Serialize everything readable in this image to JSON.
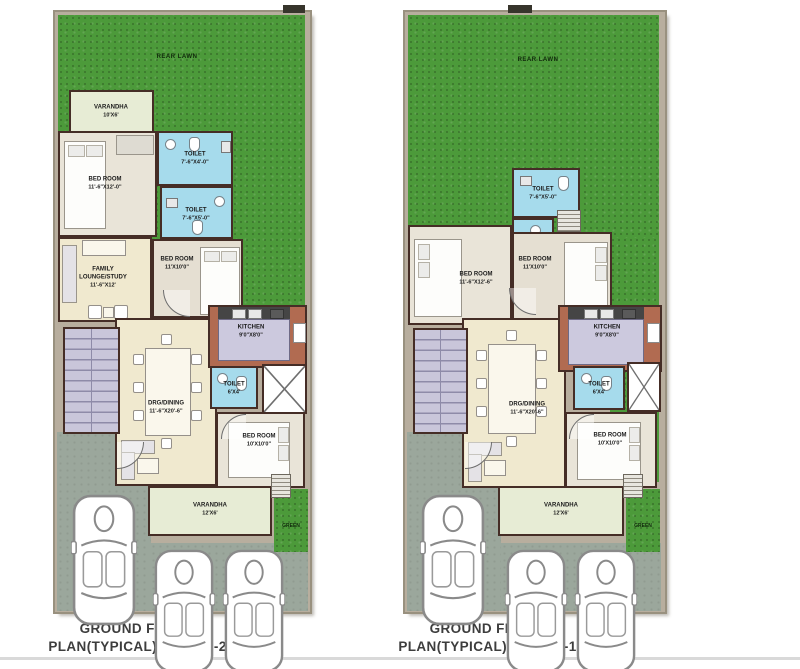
{
  "colors": {
    "lawn_green": "#4c9a3a",
    "wall_brown": "#452d26",
    "toilet_blue": "#a6dbec",
    "kitchen_brick": "#b16b51",
    "kitchen_floor": "#ccc9de",
    "room_cream": "#f0e9cf",
    "bedroom_floor": "#e9e4d8",
    "stairs_lavender": "#c9c6da",
    "driveway_gray": "#9ba79c",
    "varandha_pale": "#e7ecd5",
    "plot_band_tan": "#b8ae9e",
    "title_gray": "#3d3d3d"
  },
  "plans": {
    "left": {
      "title_line1": "GROUND FLOOR",
      "title_line2": "PLAN(TYPICAL)  PHASE-2",
      "lawn_label": "REAR LAWN",
      "green_label": "GREEN",
      "rooms": {
        "varandha_top": {
          "name": "VARANDHA",
          "dims": "10'X6'"
        },
        "bed_top": {
          "name": "BED ROOM",
          "dims": "11'-6\"X12'-0\""
        },
        "toilet_a": {
          "name": "TOILET",
          "dims": "7'-6\"X4'-0\""
        },
        "toilet_b": {
          "name": "TOILET",
          "dims": "7'-6\"X5'-0\""
        },
        "bed_mid": {
          "name": "BED ROOM",
          "dims": "11'X10'0\""
        },
        "family": {
          "name": "FAMILY LOUNGE/STUDY",
          "dims": "11'-6\"X12'"
        },
        "kitchen": {
          "name": "KITCHEN",
          "dims": "9'0\"X8'0\""
        },
        "toilet_c": {
          "name": "TOILET",
          "dims": "6'X4'"
        },
        "drg": {
          "name": "DRG/DINING",
          "dims": "11'-6\"X20'-6\""
        },
        "bed_bottom": {
          "name": "BED ROOM",
          "dims": "10'X10'0\""
        },
        "varandha_bottom": {
          "name": "VARANDHA",
          "dims": "12'X6'"
        }
      }
    },
    "right": {
      "title_line1": "GROUND FLOOR",
      "title_line2": "PLAN(TYPICAL)  PHASE-1",
      "lawn_label": "REAR LAWN",
      "green_label": "GREEN",
      "rooms": {
        "toilet_top": {
          "name": "TOILET",
          "dims": "7'-6\"X5'-0\""
        },
        "bed_left": {
          "name": "BED ROOM",
          "dims": "11'-6\"X12'-6\""
        },
        "bed_mid": {
          "name": "BED ROOM",
          "dims": "11'X10'0\""
        },
        "kitchen": {
          "name": "KITCHEN",
          "dims": "9'0\"X8'0\""
        },
        "toilet_small": {
          "name": "TOILET",
          "dims": "6'X4'"
        },
        "drg": {
          "name": "DRG/DINING",
          "dims": "11'-6\"X20'-6\""
        },
        "bed_bottom": {
          "name": "BED ROOM",
          "dims": "10'X10'0\""
        },
        "varandha": {
          "name": "VARANDHA",
          "dims": "12'X6'"
        }
      }
    }
  }
}
